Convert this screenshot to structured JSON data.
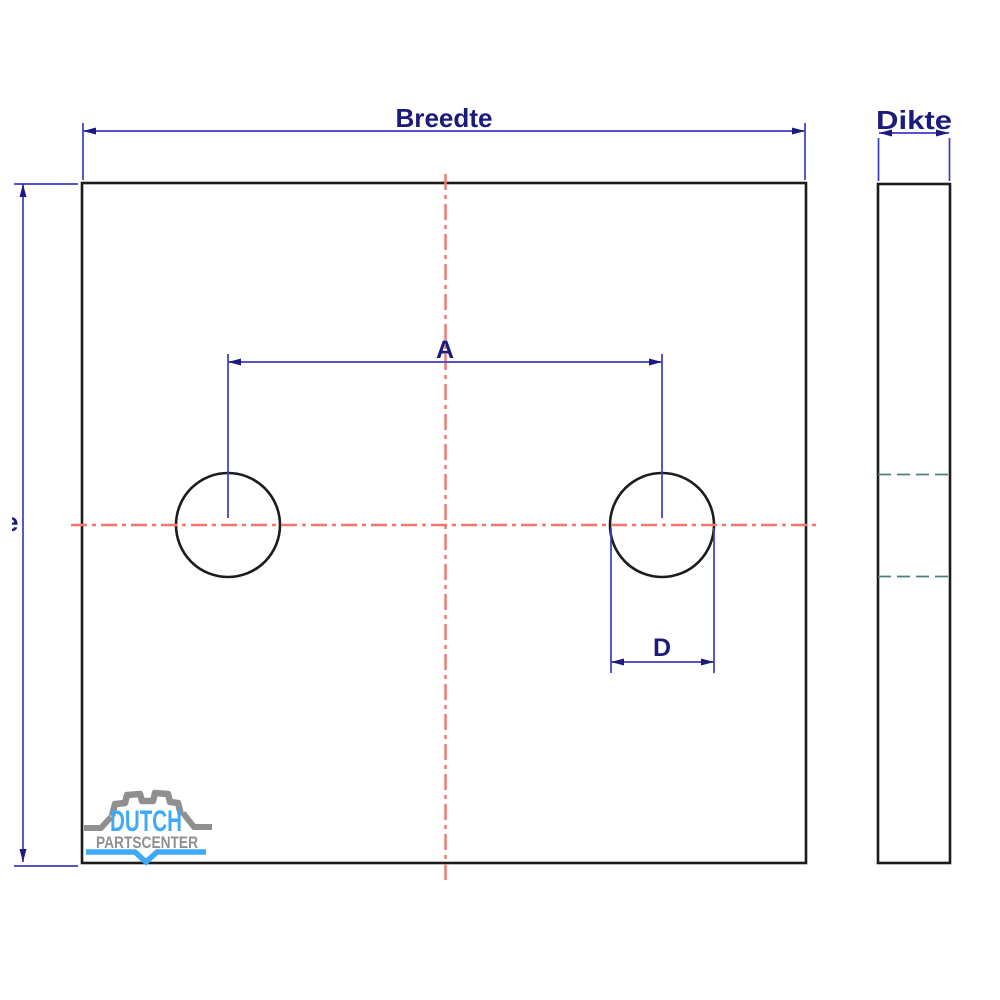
{
  "drawing": {
    "width_label": "Breedte",
    "thickness_label": "Dikte",
    "hole_spacing_label": "A",
    "hole_diameter_label": "D",
    "height_label_fragment": "e"
  },
  "logo": {
    "name": "DUTCH",
    "subtitle": "PARTSCENTER"
  },
  "colors": {
    "background": "#ffffff",
    "outline": "#1c1c1c",
    "dimension_line": "#3c3cc0",
    "dimension_text": "#1b1b7d",
    "centerline_red": "#f4756b",
    "hidden_line_teal": "#4d8080",
    "logo_blue": "#3fa9f5",
    "logo_gray": "#8f8f8f"
  }
}
